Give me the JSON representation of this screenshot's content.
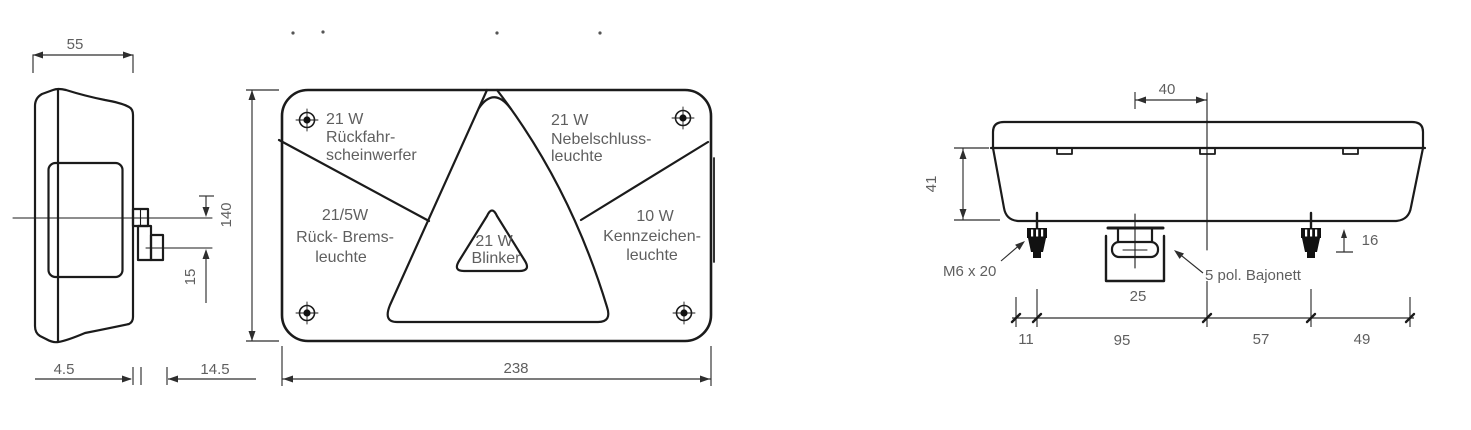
{
  "page": {
    "description": "Technical dimension drawing of a multi-function trailer rear lamp shown in three orthographic views",
    "background": "#ffffff",
    "line_color": "#1b1b1b",
    "text_color": "#5f5f5f"
  },
  "side_view": {
    "dim_width": "55",
    "dim_connector_offset": "15",
    "dim_lens_depth": "4.5",
    "dim_mount_depth": "14.5"
  },
  "front_view": {
    "dim_height": "140",
    "dim_width": "238",
    "reverse_lamp": {
      "line1": "21 W",
      "line2": "Rückfahr-",
      "line3": "scheinwerfer"
    },
    "fog_lamp": {
      "line1": "21 W",
      "line2": "Nebelschluss-",
      "line3": "leuchte"
    },
    "tail_brake_lamp": {
      "line1": "21/5W",
      "line2": "Rück- Brems-",
      "line3": "leuchte"
    },
    "plate_lamp": {
      "line1": "10 W",
      "line2": "Kennzeichen-",
      "line3": "leuchte"
    },
    "indicator_lamp": {
      "line1": "21 W",
      "line2": "Blinker"
    }
  },
  "top_view": {
    "dim_connector_to_center": "40",
    "dim_height": "41",
    "dim_bolt_protrusion": "16",
    "dim_connector_width": "25",
    "dim_edge_to_bolt": "11",
    "dim_bolt_to_connector": "95",
    "dim_connector_to_bolt2": "57",
    "dim_bolt2_to_edge": "49",
    "bolt_label": "M6 x 20",
    "connector_label": "5 pol. Bajonett"
  }
}
